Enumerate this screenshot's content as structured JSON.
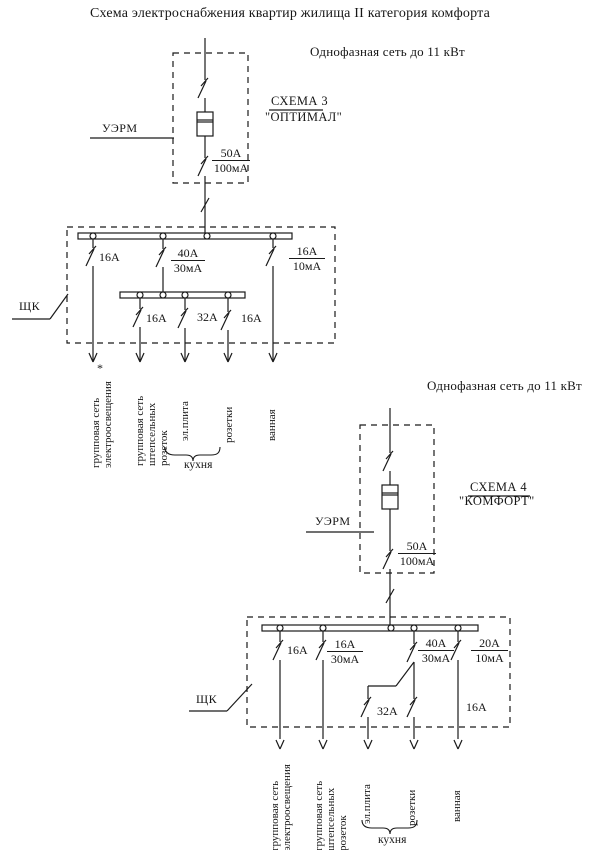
{
  "title": "Схема электроснабжения квартир жилища II категория комфорта",
  "footnote_mark": "*",
  "scheme1": {
    "network": "Однофазная сеть до 11 кВт",
    "uerm": "УЭРМ",
    "name": "СХЕМА 3",
    "variant": "\"ОПТИМАЛ\"",
    "input_current": "50A",
    "input_leakage": "100мА",
    "panel": "ЩК",
    "lighting_breaker": "16A",
    "diff_current": "40A",
    "diff_leakage": "30мА",
    "bath_current": "16A",
    "bath_leakage": "10мА",
    "sockets_breaker": "16A",
    "stove_breaker": "32A",
    "kitchen_sockets_breaker": "16A",
    "out_lighting": "групповая сеть\nэлектроосвещения",
    "out_sockets": "групповая сеть\nштепсельных\nрозеток",
    "out_stove": "эл.плита",
    "out_kitchen_sockets": "розетки",
    "out_bath": "ванная",
    "kitchen_group": "кухня"
  },
  "scheme2": {
    "network": "Однофазная сеть до 11 кВт",
    "uerm": "УЭРМ",
    "name": "СХЕМА 4",
    "variant": "\"КОМФОРТ\"",
    "input_current": "50A",
    "input_leakage": "100мА",
    "panel": "ЩК",
    "lighting_breaker": "16A",
    "sockets_current": "16A",
    "sockets_leakage": "30мА",
    "diff_current": "40A",
    "diff_leakage": "30мА",
    "bath_current": "20A",
    "bath_leakage": "10мА",
    "stove_breaker": "32A",
    "bath_breaker": "16A",
    "out_lighting": "групповая сеть\nэлектроосвещения",
    "out_sockets": "групповая сеть\nштепсельных\nрозеток",
    "out_stove": "эл.плита",
    "out_kitchen_sockets": "розетки",
    "out_bath": "ванная",
    "kitchen_group": "кухня"
  }
}
